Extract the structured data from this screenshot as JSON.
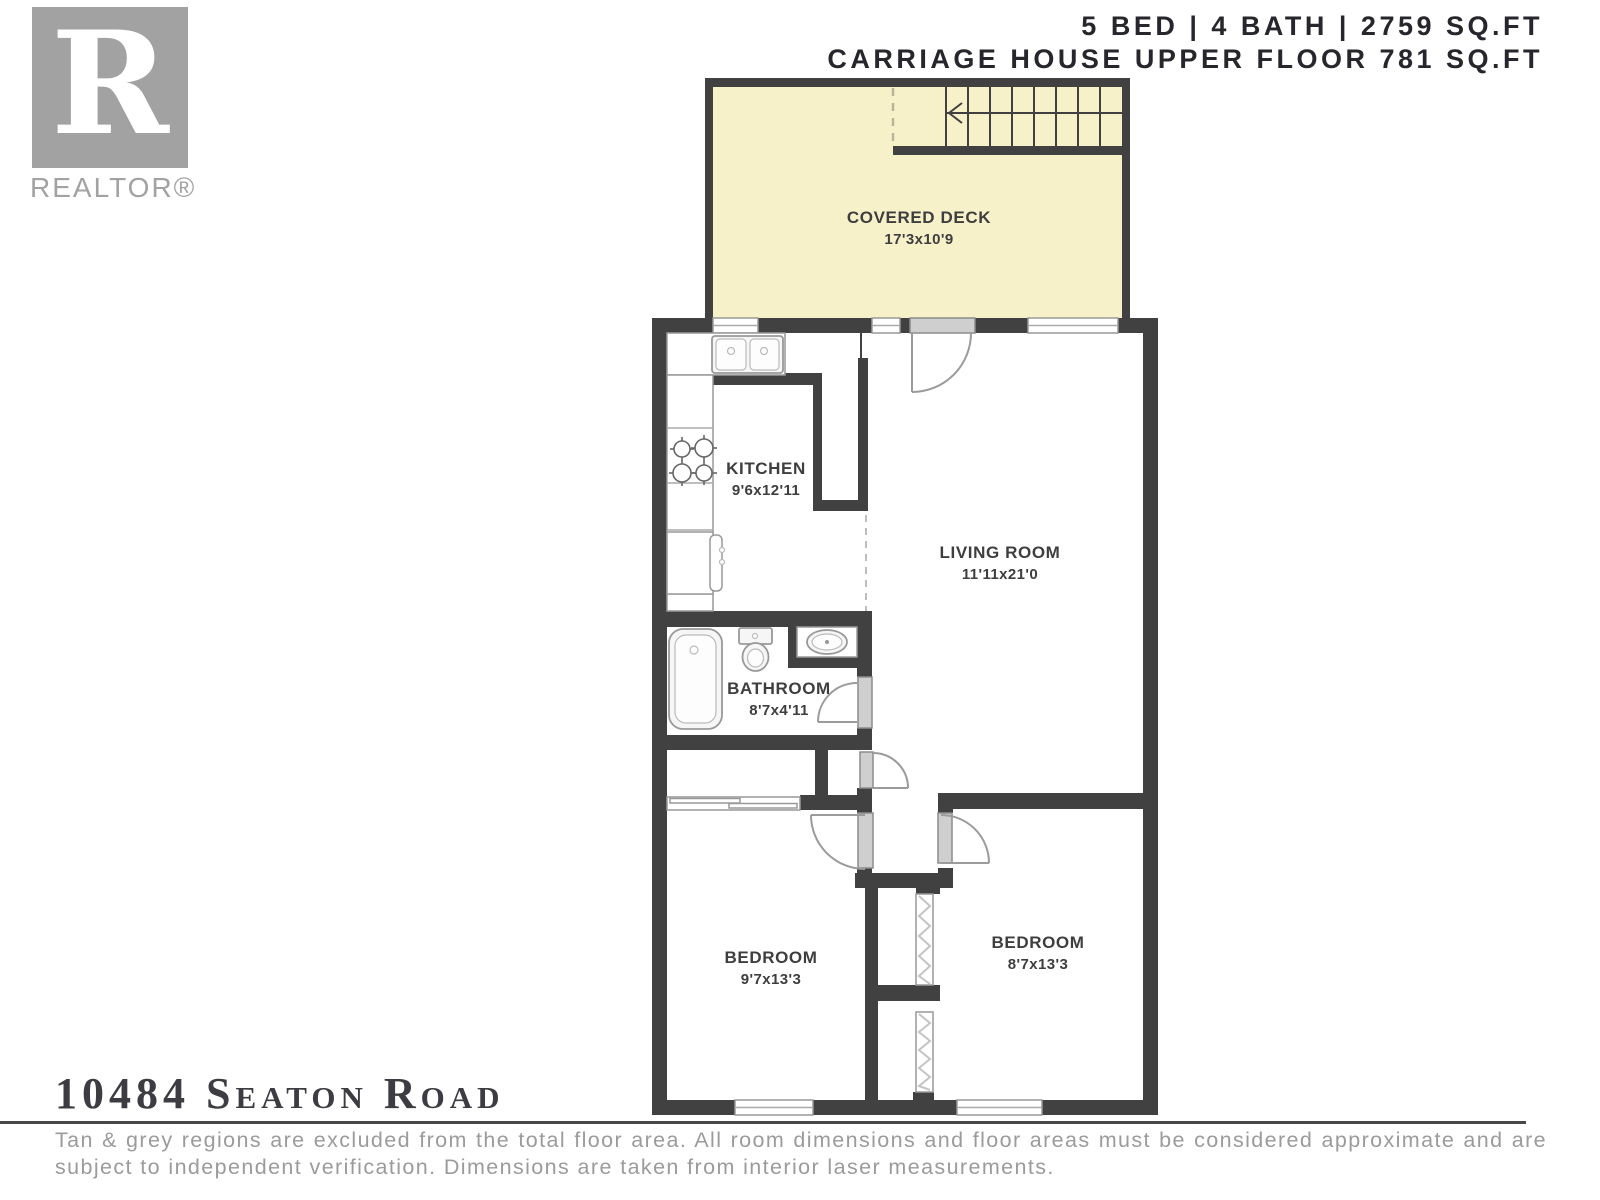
{
  "header": {
    "line1": "5 BED | 4 BATH | 2759 SQ.FT",
    "line2": "CARRIAGE HOUSE UPPER FLOOR 781 SQ.FT"
  },
  "logo": {
    "letter": "R",
    "label": "REALTOR®"
  },
  "rooms": {
    "covered_deck": {
      "name": "COVERED DECK",
      "dims": "17'3x10'9"
    },
    "kitchen": {
      "name": "KITCHEN",
      "dims": "9'6x12'11"
    },
    "living_room": {
      "name": "LIVING ROOM",
      "dims": "11'11x21'0"
    },
    "bathroom": {
      "name": "BATHROOM",
      "dims": "8'7x4'11"
    },
    "bedroom_left": {
      "name": "BEDROOM",
      "dims": "9'7x13'3"
    },
    "bedroom_right": {
      "name": "BEDROOM",
      "dims": "8'7x13'3"
    }
  },
  "footer": {
    "address": "10484 Seaton Road",
    "disclaimer": "Tan & grey regions are excluded from the total floor area. All room dimensions and floor areas must be considered approximate and are subject to independent verification. Dimensions are taken from interior laser measurements."
  },
  "colors": {
    "wall": "#414141",
    "deck_fill": "#f7f1ca",
    "door_panel": "#cfcfcf",
    "label_text": "#3e3e3e",
    "header_text": "#26262c",
    "footer_gray": "#9b9b9b",
    "logo_gray": "#a2a2a2"
  }
}
